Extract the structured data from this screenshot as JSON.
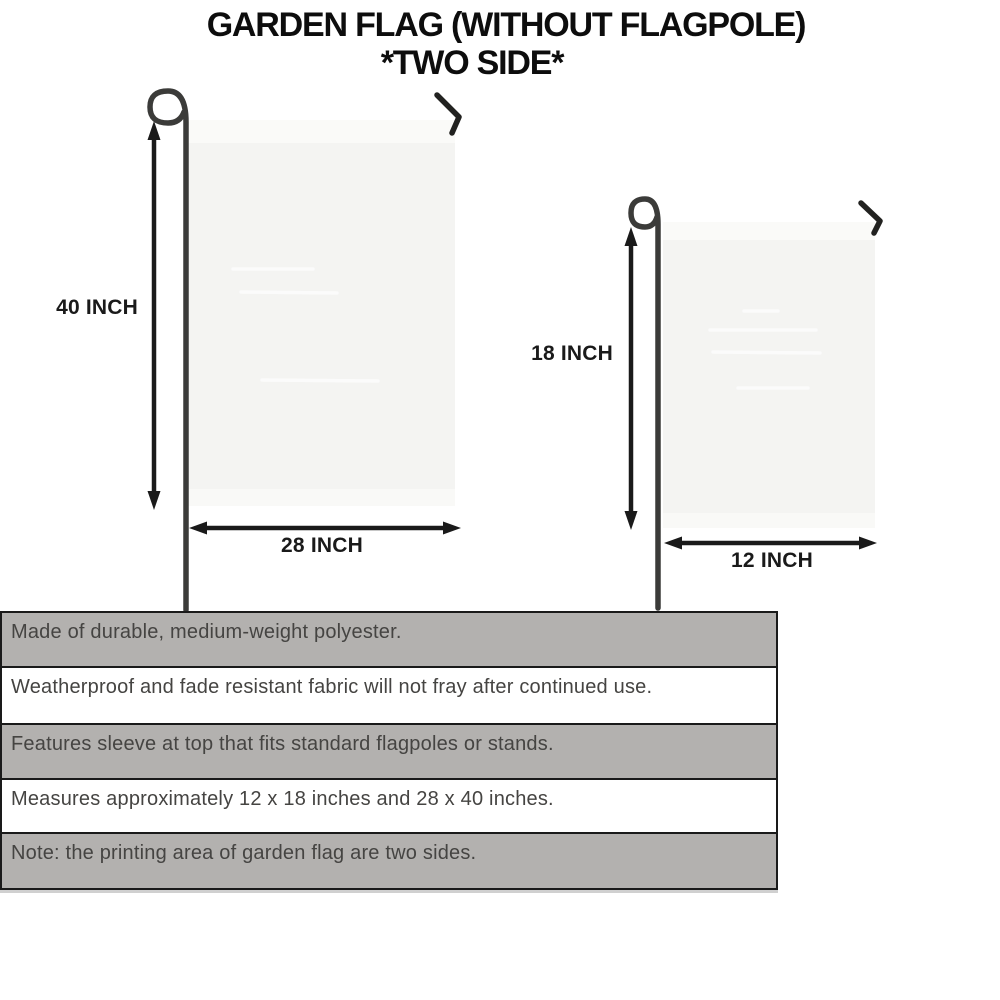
{
  "title": {
    "line1": "GARDEN FLAG (WITHOUT FLAGPOLE)",
    "line2": "*TWO SIDE*"
  },
  "diagram": {
    "large_flag": {
      "height_label": "40 INCH",
      "width_label": "28 INCH"
    },
    "small_flag": {
      "height_label": "18 INCH",
      "width_label": "12 INCH"
    }
  },
  "features": {
    "rows": [
      "Made of durable, medium-weight polyester.",
      "Weatherproof and fade resistant fabric will not fray after continued use.",
      "Features sleeve at top that fits standard flagpoles or stands.",
      "Measures approximately 12 x 18 inches and 28 x 40 inches.",
      "Note: the printing area of garden flag are two sides."
    ]
  },
  "colors": {
    "title_color": "#0d0d0d",
    "accent": "#1a1a1a",
    "pole": "#3b3b39",
    "flag_fill": "#f4f4f2",
    "flag_sleeve": "#fafaf8",
    "row_shaded": "#b3b1af",
    "row_plain": "#ffffff",
    "row_text": "#454442",
    "border": "#1a1a1a"
  }
}
